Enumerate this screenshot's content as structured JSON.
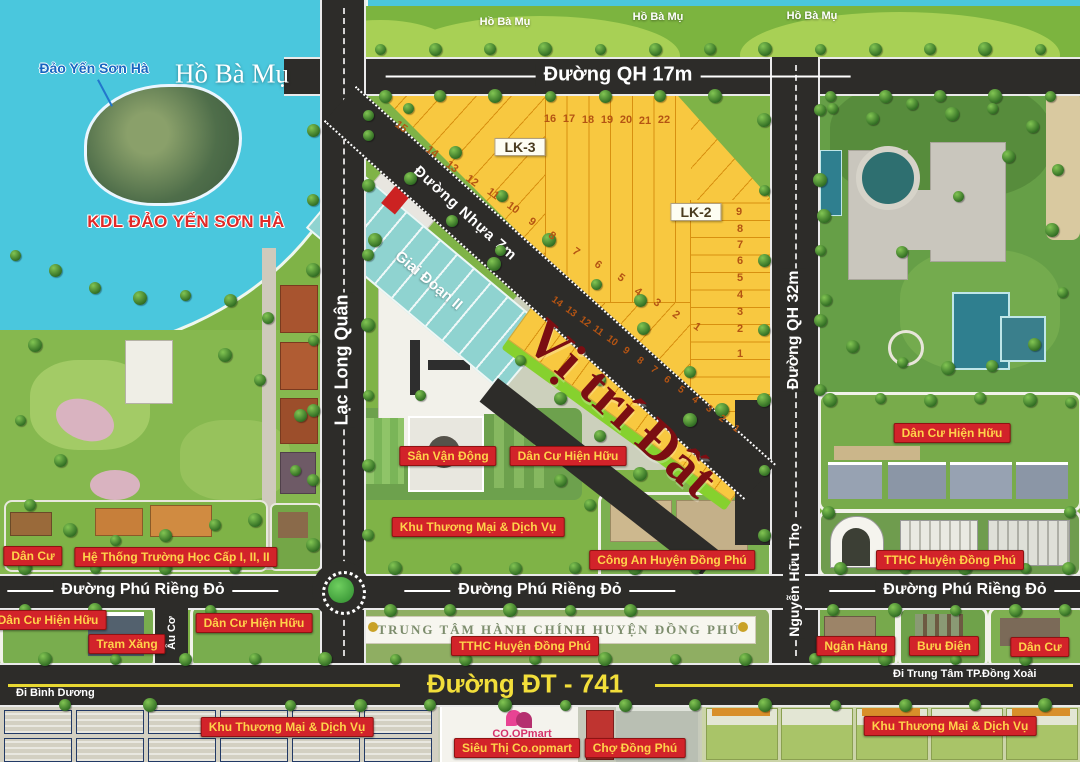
{
  "water": {
    "lake_label": "Hồ Bà Mụ",
    "island_label": "Đảo Yến Sơn Hà",
    "kdl_label": "KDL ĐẢO YẾN SƠN HÀ",
    "shore_labels": [
      "Hồ Bà Mụ",
      "Hồ Bà Mụ",
      "Hồ Bà Mụ"
    ]
  },
  "roads": {
    "qh17": "Đường QH 17m",
    "qh32": "Đường QH 32m",
    "lac_long_quan": "Lạc Long Quân",
    "nguyen_huu_tho": "Nguyễn Hữu Thọ",
    "au_co": "Âu Cơ",
    "nhua7": "Đường Nhựa 7m",
    "phu_rieng_do": "Đường Phú Riềng Đỏ",
    "dt741": "Đường ĐT - 741",
    "di_binh_duong": "Đi Bình Dương",
    "di_dong_xoai": "Đi Trung Tâm TP.Đồng Xoài"
  },
  "zones": {
    "lk3": "LK-3",
    "lk2": "LK-2",
    "giai_doan_2": "Giai Đoạn II",
    "vi_tri_dat": "Vị trí Đất",
    "admin_banner": "TRUNG TÂM HÀNH CHÍNH HUYỆN ĐỒNG PHÚ",
    "coopmart": "CO.OPmart"
  },
  "map_labels": [
    {
      "id": "dan-cu-nw",
      "text": "Dân Cư",
      "x": 33,
      "y": 556
    },
    {
      "id": "truong-hoc",
      "text": "Hệ Thống Trường Học Cấp I, II, II",
      "x": 176,
      "y": 557
    },
    {
      "id": "san-van-dong",
      "text": "Sân Vận Động",
      "x": 448,
      "y": 456
    },
    {
      "id": "dan-cu-hien-huu-center",
      "text": "Dân Cư Hiện Hữu",
      "x": 568,
      "y": 456
    },
    {
      "id": "khu-tm-dv-center",
      "text": "Khu Thương Mại & Dịch Vụ",
      "x": 478,
      "y": 527
    },
    {
      "id": "cong-an-huyen-dong-phu",
      "text": "Công An Huyện Đồng Phú",
      "x": 672,
      "y": 560
    },
    {
      "id": "dan-cu-hien-huu-east",
      "text": "Dân Cư Hiện Hữu",
      "x": 952,
      "y": 433
    },
    {
      "id": "tthc-huyen-dong-phu-east",
      "text": "TTHC Huyện Đồng Phú",
      "x": 950,
      "y": 560
    },
    {
      "id": "dan-cu-hien-huu-sw",
      "text": "Dân Cư Hiện Hữu",
      "x": 48,
      "y": 620
    },
    {
      "id": "tram-xang",
      "text": "Trạm Xăng",
      "x": 127,
      "y": 644
    },
    {
      "id": "dan-cu-hien-huu-south",
      "text": "Dân Cư Hiện Hữu",
      "x": 254,
      "y": 623
    },
    {
      "id": "tthc-huyen-dong-phu-south",
      "text": "TTHC Huyện Đồng Phú",
      "x": 525,
      "y": 646
    },
    {
      "id": "ngan-hang",
      "text": "Ngân Hàng",
      "x": 856,
      "y": 646
    },
    {
      "id": "buu-dien",
      "text": "Bưu Điện",
      "x": 944,
      "y": 646
    },
    {
      "id": "dan-cu-se",
      "text": "Dân Cư",
      "x": 1040,
      "y": 647
    },
    {
      "id": "khu-tm-dv-sw",
      "text": "Khu Thương Mại & Dịch Vụ",
      "x": 287,
      "y": 727
    },
    {
      "id": "sieu-thi-coopmart",
      "text": "Siêu Thị Co.opmart",
      "x": 517,
      "y": 748
    },
    {
      "id": "cho-dong-phu",
      "text": "Chợ Đồng Phú",
      "x": 635,
      "y": 748
    },
    {
      "id": "khu-tm-dv-se",
      "text": "Khu Thương Mại & Dịch Vụ",
      "x": 950,
      "y": 726
    }
  ],
  "plots": {
    "lk3_top": {
      "rot": 0,
      "size": 11,
      "items": [
        [
          16,
          550,
          119
        ],
        [
          17,
          569,
          119
        ],
        [
          18,
          588,
          120
        ],
        [
          19,
          607,
          120
        ],
        [
          20,
          626,
          120
        ],
        [
          21,
          645,
          121
        ],
        [
          22,
          664,
          120
        ]
      ]
    },
    "lk3_diag": {
      "rot": 36,
      "size": 11,
      "items": [
        [
          15,
          401,
          127
        ],
        [
          14,
          432,
          152
        ],
        [
          13,
          452,
          167
        ],
        [
          12,
          472,
          181
        ],
        [
          11,
          493,
          194
        ],
        [
          10,
          513,
          208
        ],
        [
          9,
          532,
          222
        ],
        [
          8,
          552,
          236
        ]
      ]
    },
    "lk2_diag": {
      "rot": 36,
      "size": 11,
      "items": [
        [
          7,
          576,
          252
        ],
        [
          6,
          598,
          265
        ],
        [
          5,
          621,
          278
        ],
        [
          4,
          638,
          292
        ],
        [
          3,
          657,
          303
        ],
        [
          2,
          676,
          315
        ],
        [
          1,
          697,
          327
        ]
      ]
    },
    "lk2_col": {
      "rot": 0,
      "size": 11,
      "items": [
        [
          9,
          739,
          212
        ],
        [
          8,
          740,
          229
        ],
        [
          7,
          740,
          245
        ],
        [
          6,
          740,
          261
        ],
        [
          5,
          740,
          278
        ],
        [
          4,
          740,
          295
        ],
        [
          3,
          740,
          312
        ],
        [
          2,
          740,
          329
        ],
        [
          1,
          740,
          354
        ]
      ]
    },
    "strip": {
      "rot": 36,
      "size": 10,
      "items": [
        [
          14,
          557,
          302
        ],
        [
          13,
          571,
          312
        ],
        [
          12,
          585,
          322
        ],
        [
          11,
          598,
          331
        ],
        [
          10,
          612,
          341
        ],
        [
          9,
          626,
          351
        ],
        [
          8,
          640,
          361
        ],
        [
          7,
          654,
          370
        ],
        [
          6,
          667,
          380
        ],
        [
          5,
          681,
          390
        ],
        [
          4,
          695,
          400
        ],
        [
          3,
          709,
          409
        ],
        [
          2,
          722,
          419
        ],
        [
          1,
          736,
          429
        ]
      ]
    }
  },
  "colors": {
    "water": "#4ac7dd",
    "road": "#2d2c29",
    "plot_yellow": "#f8c840",
    "phase2_teal": "#8fd3d0",
    "label_red_bg": "#d2232a",
    "label_text_yellow": "#ffd24a",
    "highlight_maroon": "#7b0e12",
    "lime_highlight": "#86d12e",
    "dt741_yellow": "#e8d832"
  }
}
